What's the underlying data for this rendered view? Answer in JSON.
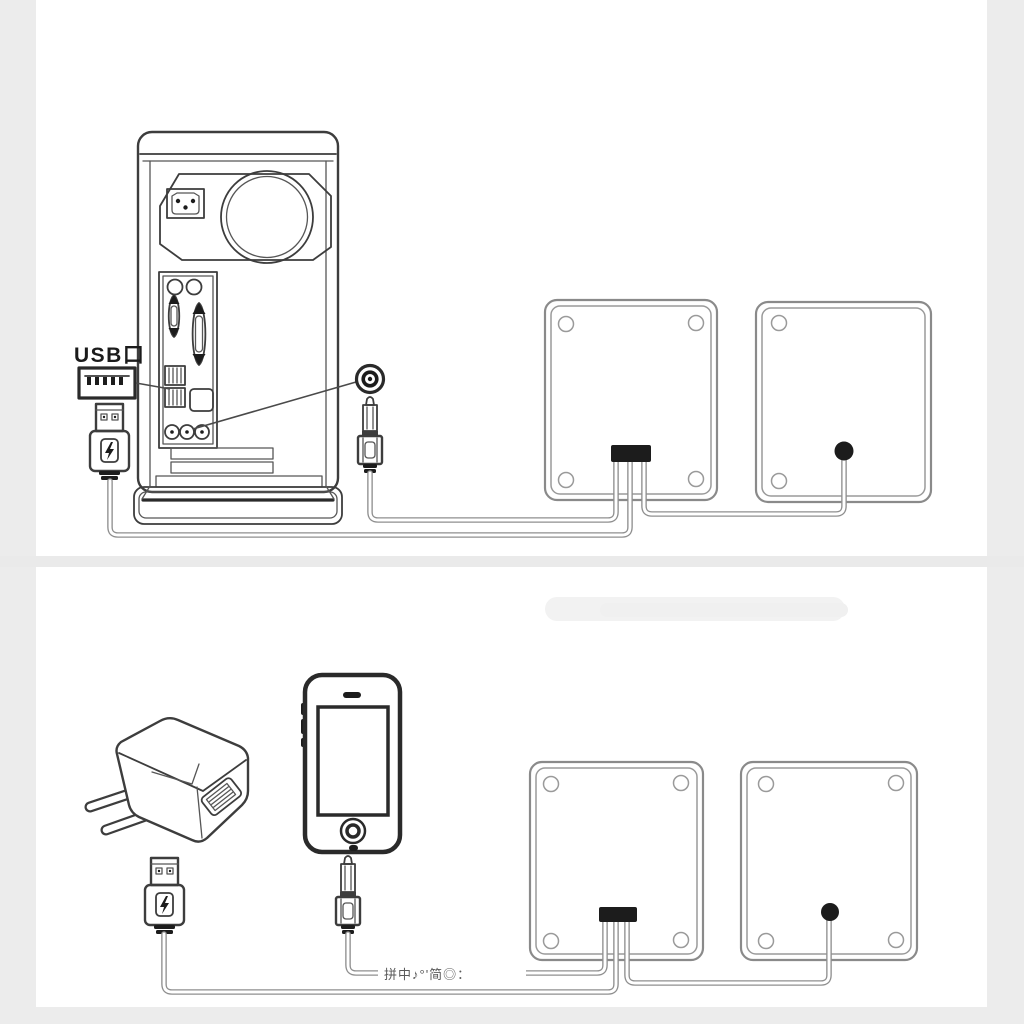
{
  "page": {
    "type": "product-connection-instruction-diagram",
    "colors": {
      "page_background": "#ececec",
      "panel_background": "#ffffff",
      "separator_band": "#eaeaea",
      "line_ink": "#3d3d3d",
      "light_ink": "#8a8a8a",
      "solid_fill": "#1c1c1c"
    }
  },
  "top_panel": {
    "usb_label": "USB口",
    "components": [
      "pc-tower-rear-view",
      "usb-port-symbol",
      "usb-plug",
      "audio-out-target",
      "audio-jack-plug-3.5mm",
      "left-speaker-rear",
      "right-speaker-rear"
    ],
    "connections": [
      "usb-plug to pc-usb-port (power)",
      "3.5mm-jack to pc-audio-out (green jack)",
      "left-speaker terminal to right-speaker"
    ]
  },
  "bottom_panel": {
    "watermark": "拼中♪°'简◎：",
    "components": [
      "power-adapter-wall-charger",
      "smartphone",
      "usb-plug",
      "audio-jack-plug-3.5mm",
      "left-speaker-rear",
      "right-speaker-rear"
    ],
    "connections": [
      "usb-plug to power-adapter (power)",
      "3.5mm-jack to smartphone headphone output",
      "left-speaker terminal to right-speaker"
    ]
  }
}
